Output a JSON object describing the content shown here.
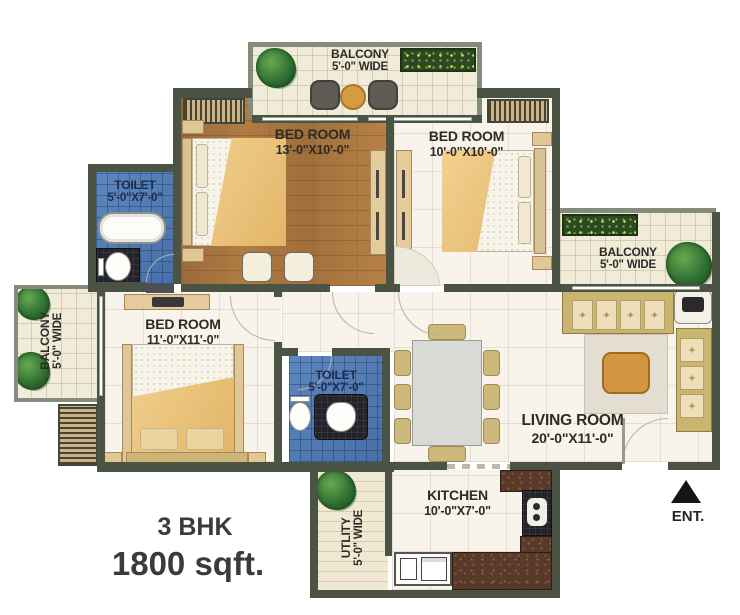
{
  "plan_title": "3 BHK",
  "plan_area": "1800 sqft.",
  "entry": {
    "label": "ENT."
  },
  "rooms": {
    "balcony_top": {
      "name": "BALCONY",
      "size": "5'-0\" WIDE"
    },
    "balcony_left": {
      "name": "BALCONY",
      "size": "5'-0\" WIDE"
    },
    "balcony_right": {
      "name": "BALCONY",
      "size": "5'-0\" WIDE"
    },
    "bedroom_top_left": {
      "name": "BED ROOM",
      "size": "13'-0\"X10'-0\""
    },
    "bedroom_top_right": {
      "name": "BED ROOM",
      "size": "10'-0\"X10'-0\""
    },
    "bedroom_bottom": {
      "name": "BED ROOM",
      "size": "11'-0\"X11'-0\""
    },
    "toilet_top": {
      "name": "TOILET",
      "size": "5'-0\"X7'-0\""
    },
    "toilet_middle": {
      "name": "TOILET",
      "size": "5'-0\"X7'-0\""
    },
    "living_room": {
      "name": "LIVING ROOM",
      "size": "20'-0\"X11'-0\""
    },
    "kitchen": {
      "name": "KITCHEN",
      "size": "10'-0\"X7'-0\""
    },
    "utility": {
      "name": "UTLITY",
      "size": "5'-0\" WIDE"
    }
  },
  "colors": {
    "wall": "#4b5344",
    "balcony-wall": "#868c7a",
    "label": "#2d2b28",
    "toilet-label": "#1d2c4e",
    "title": "#3d3b39",
    "sofa": "#c9b570",
    "cushion": "#ecdfba",
    "wood-floor": "#a9743f",
    "blue-tile": "#4d79b4",
    "accent-table": "#d29540",
    "plant": "#2e7030",
    "granite": "#59392a"
  }
}
